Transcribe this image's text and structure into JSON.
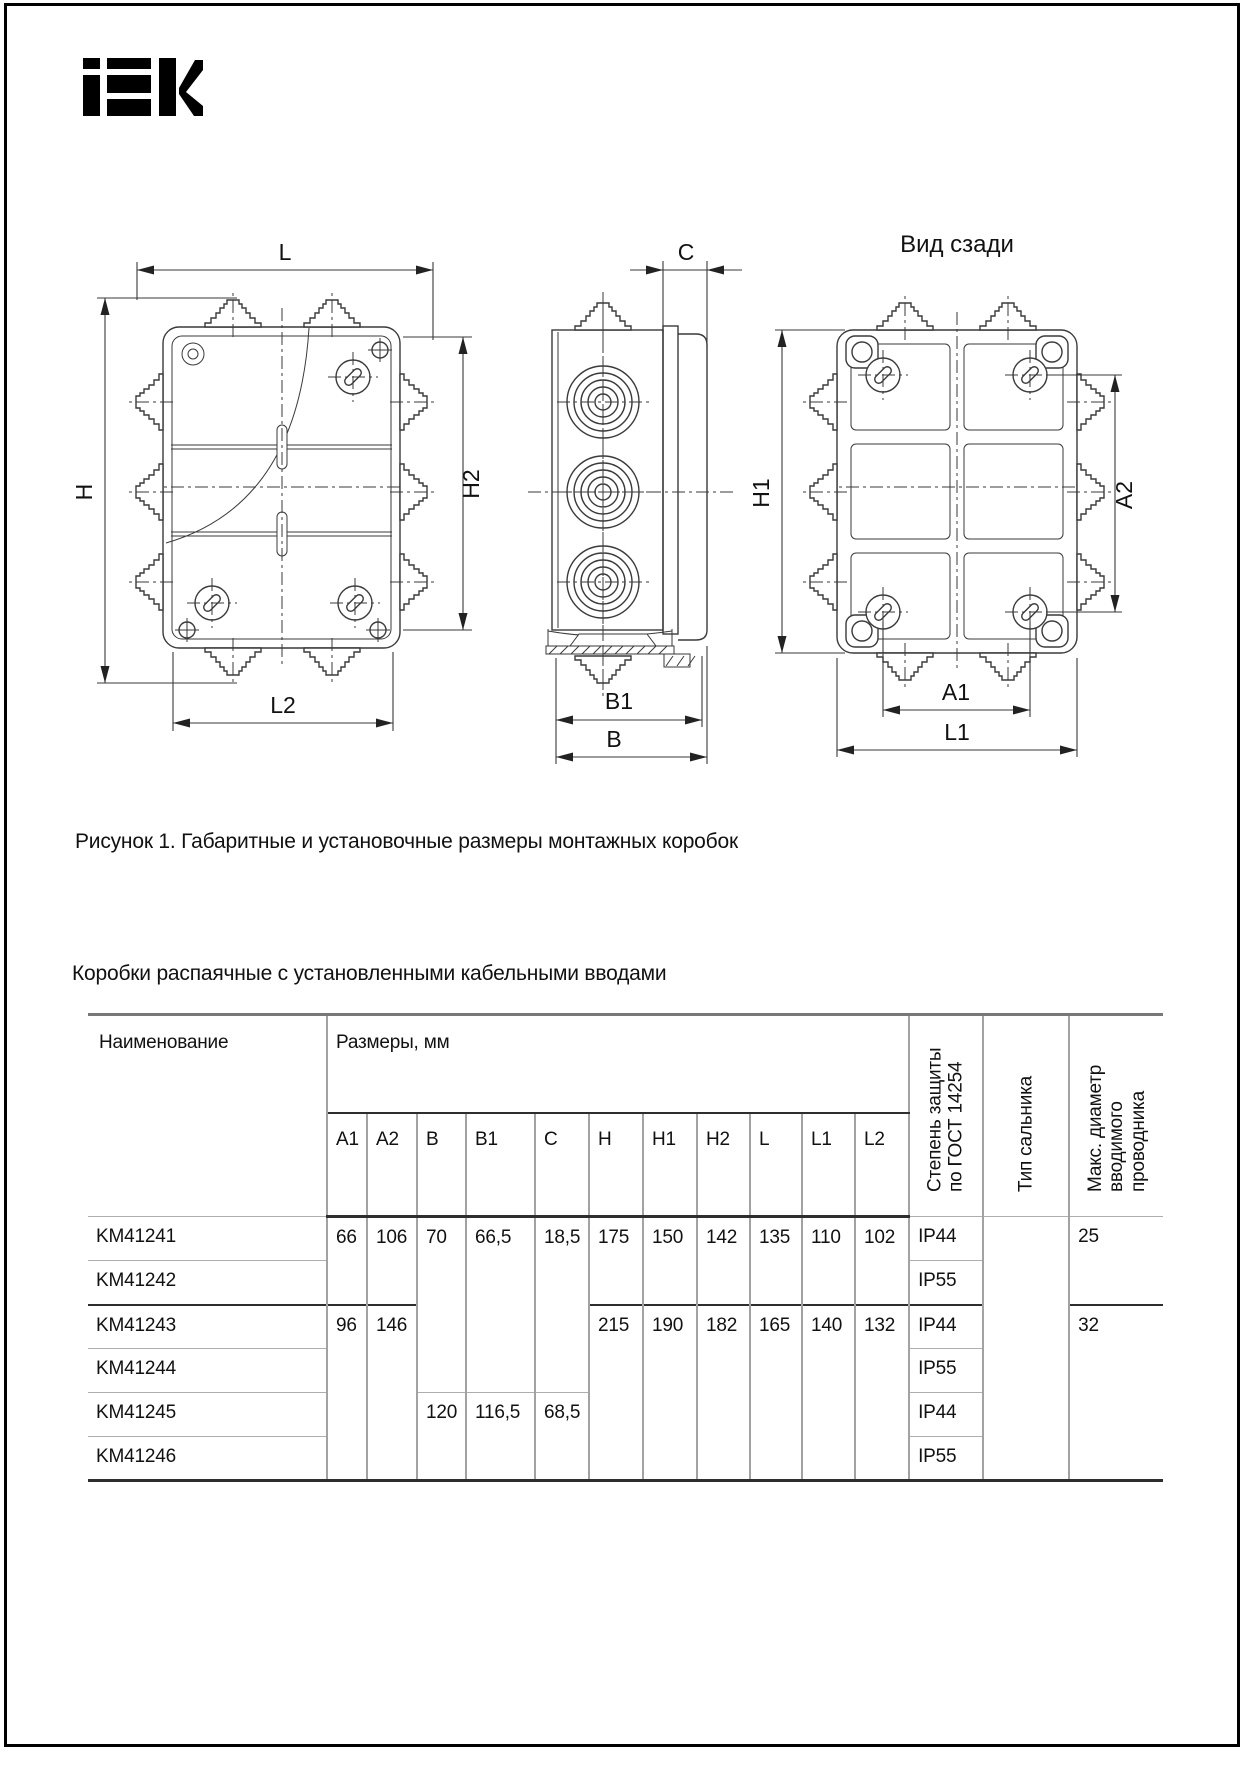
{
  "logo": {
    "alt": "IEK"
  },
  "figure": {
    "rear_title": "Вид сзади",
    "labels": {
      "l": "L",
      "h": "H",
      "h2": "H2",
      "l2": "L2",
      "c": "C",
      "b1": "B1",
      "b": "B",
      "h1": "H1",
      "a2": "A2",
      "a1": "A1",
      "l1": "L1"
    },
    "caption": "Рисунок 1. Габаритные и установочные размеры монтажных коробок"
  },
  "table": {
    "heading": "Коробки распаячные с установленными кабельными вводами",
    "headers": {
      "name": "Наименование",
      "sizes_group": "Размеры, мм",
      "size_cols": [
        "A1",
        "A2",
        "B",
        "B1",
        "C",
        "H",
        "H1",
        "H2",
        "L",
        "L1",
        "L2"
      ],
      "protection": "Степень защиты по ГОСТ 14254",
      "gland_type": "Тип сальника",
      "max_diameter": "Макс. диаметр вводимого проводника"
    },
    "rows": [
      {
        "name": "KM41241",
        "a1": "66",
        "a2": "106",
        "b": "70",
        "b1": "66,5",
        "c": "18,5",
        "h": "175",
        "h1": "150",
        "h2": "142",
        "l": "135",
        "l1": "110",
        "l2": "102",
        "ip": "IP44",
        "max_d": "25"
      },
      {
        "name": "KM41242",
        "ip": "IP55"
      },
      {
        "name": "KM41243",
        "a1": "96",
        "a2": "146",
        "h": "215",
        "h1": "190",
        "h2": "182",
        "l": "165",
        "l1": "140",
        "l2": "132",
        "ip": "IP44",
        "max_d": "32"
      },
      {
        "name": "KM41244",
        "ip": "IP55"
      },
      {
        "name": "KM41245",
        "b": "120",
        "b1": "116,5",
        "c": "68,5",
        "ip": "IP44"
      },
      {
        "name": "KM41246",
        "ip": "IP55"
      }
    ]
  }
}
